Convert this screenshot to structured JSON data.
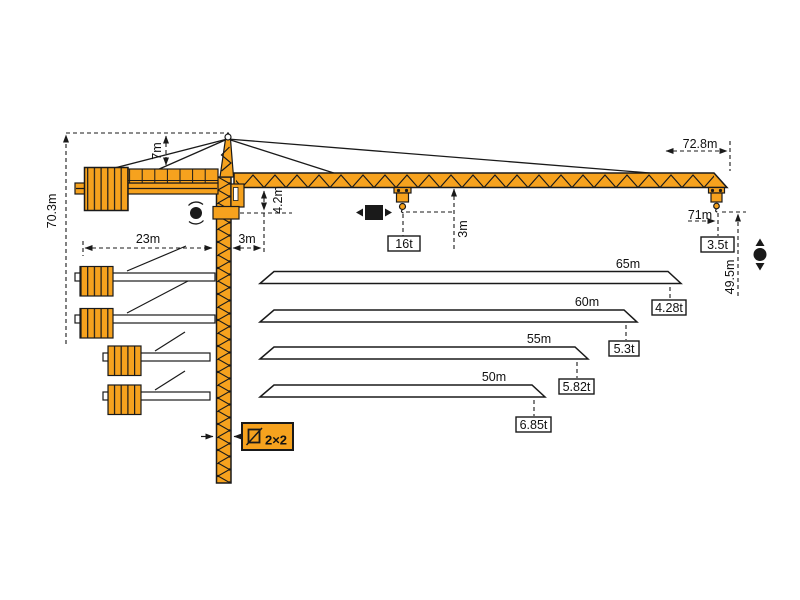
{
  "dimensions": {
    "total_height": "70.3m",
    "tower_head_height": "7m",
    "counter_jib_radius": "23m",
    "rear_offset": "3m",
    "jib_foot_clearance": "4.2m",
    "max_capacity": "16t",
    "hook_to_jib_clearance": "3m",
    "max_tip_radius": "72.8m",
    "max_hook_radius": "71m",
    "tip_capacity": "3.5t",
    "hook_height_at_tip": "49.5m",
    "mast_cross_section": "2×2"
  },
  "jib_configurations": [
    {
      "length": "65m",
      "tip_load": "4.28t"
    },
    {
      "length": "60m",
      "tip_load": "5.3t"
    },
    {
      "length": "55m",
      "tip_load": "5.82t"
    },
    {
      "length": "50m",
      "tip_load": "6.85t"
    }
  ],
  "colors": {
    "crane_orange": "#F6A21E",
    "line_black": "#1a1a1a",
    "background": "#ffffff"
  }
}
